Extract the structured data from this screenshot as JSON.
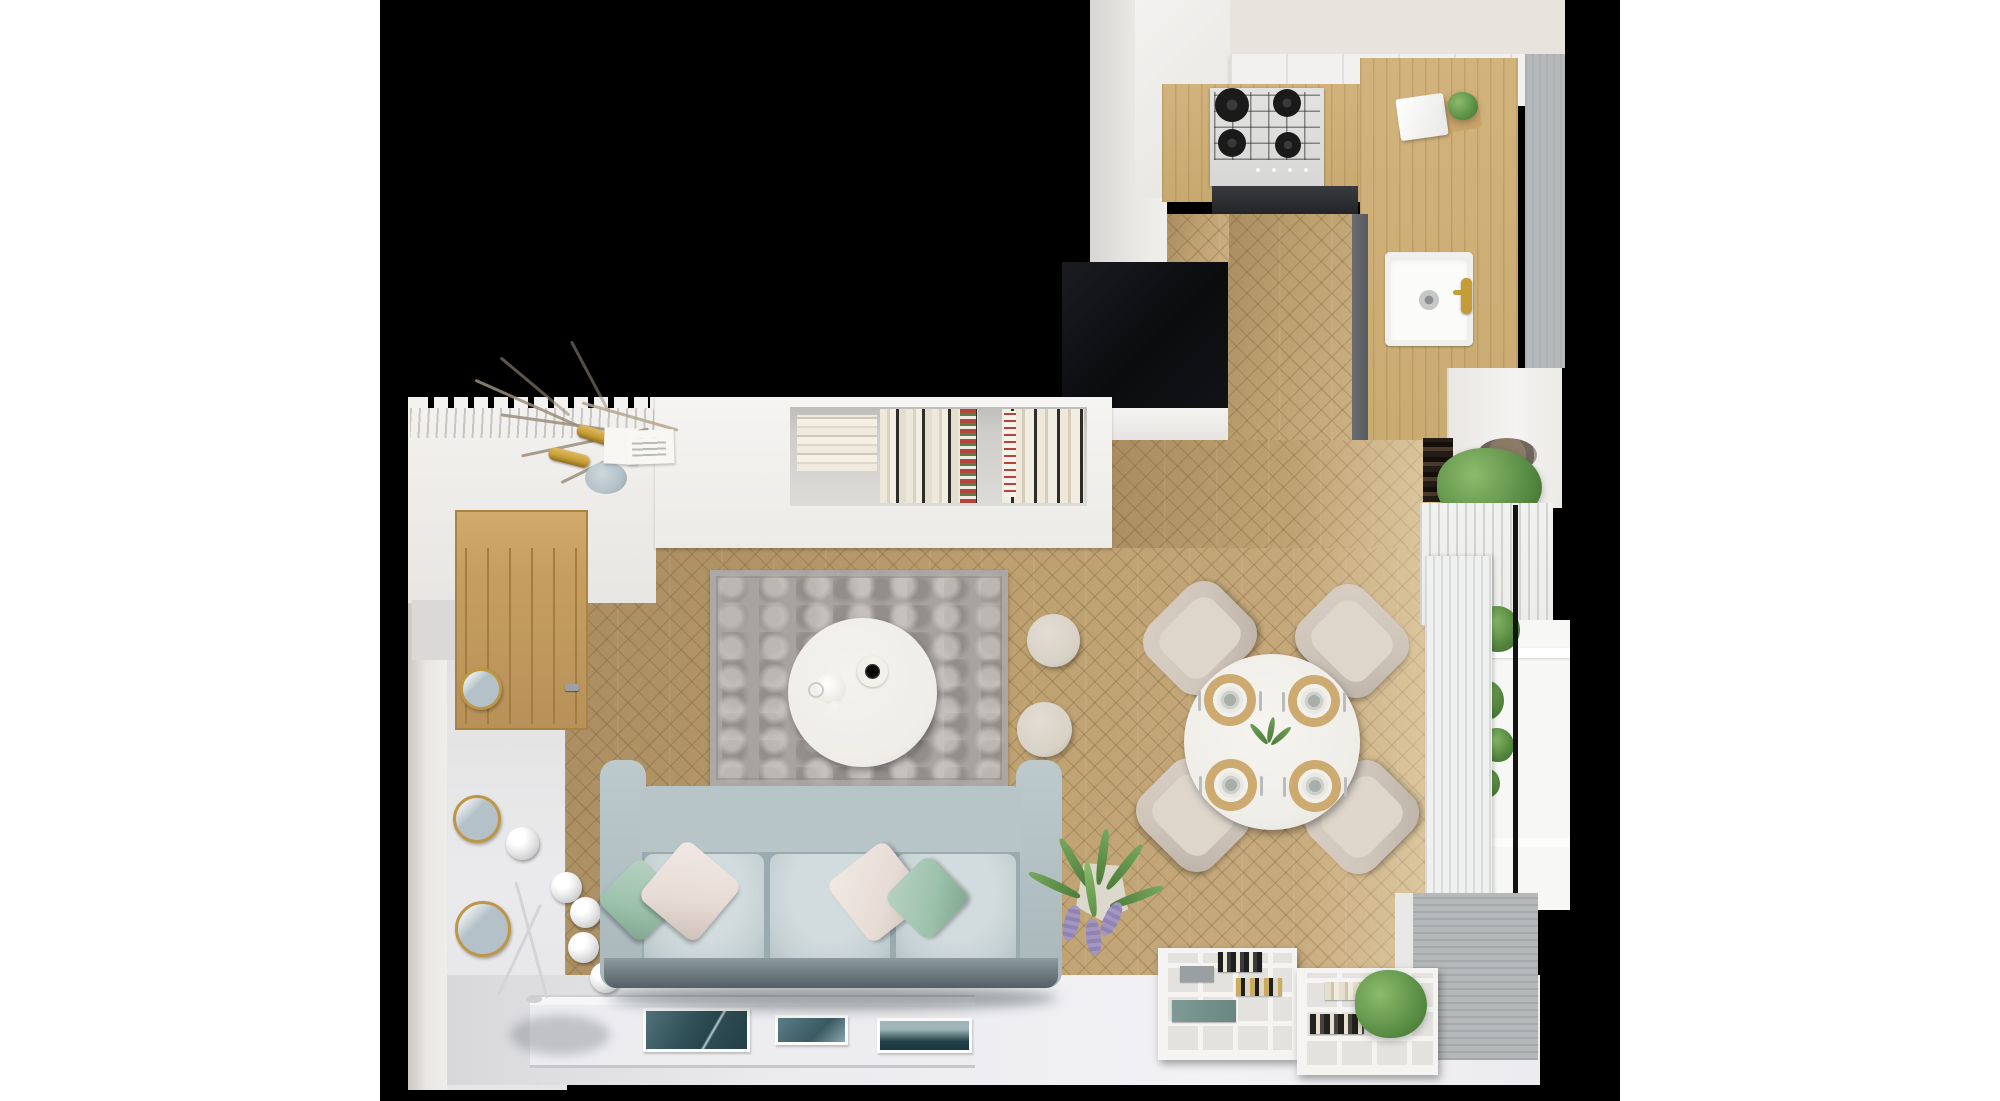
{
  "image": {
    "kind": "3d-render-top-down-floor-plan",
    "description": "Top-down architectural 3D render of a small apartment: open living room with light blue sofa, gray rug, round white coffee table, round dining table with four beige chairs, herringbone oak parquet, white bookshelf ledge, oak door, gold round mirrors, multi-sphere floor lamp, white cube shelving with books and plants, and an L-shaped kitchen with gas hob, oak counters, white sink and gold faucet; black background canvas with white page margins."
  },
  "palette": {
    "page-bg": "#ffffff",
    "render-bg": "#000000",
    "wall": "#e9e7e4",
    "cream-wall": "#e8e3dc",
    "cabinet": "#f2f1ef",
    "ledge": "#f3f2f0",
    "recess": "#cfcdc9",
    "counter-wood": "#c8a96f",
    "floor-wood": "#bda06f",
    "dark-front": "#232428",
    "gray-front": "#56595d",
    "steel": "#d7d8d6",
    "burner": "#1a1a1a",
    "sink": "#fbfbfa",
    "gold": "#c59d36",
    "curtain-gray": "#b5b8b9",
    "curtain-gray2": "#aeb1b3",
    "sheer": "#ececea",
    "beige-curtain": "#e6d5ae",
    "door-oak": "#c59e5f",
    "door-groove": "#a37d3f",
    "mirror-gold": "#bd9746",
    "mirror-glass": "#b4c1c8",
    "lamp": "#e9e9e9",
    "rug": "#a8a3a1",
    "table": "#efede8",
    "pouffe": "#d8d1c6",
    "sofa": "#b7c4c8",
    "sofa-arm": "#bccacd",
    "sofa-seat": "#c6d1d4",
    "sofa-seam": "#9aabb0",
    "sofa-front": "#525f64",
    "mint": "#9cc1ab",
    "blush": "#e7dbd5",
    "green": "#5d9148",
    "green-dark": "#41722f",
    "green-light": "#8cbb6c",
    "lavender": "#a195c6",
    "chair": "#cfc5bb",
    "chair-seat": "#ded6cb",
    "placemat": "#cdaa70",
    "radiator": "#eff0f0",
    "radiator-line": "#d8dada",
    "window": "#f7f7f5",
    "frame-black": "#141414",
    "floor-white-dark": "#d8d8db",
    "mat": "#ededf0",
    "mat-line": "#cfcfd4",
    "shelf": "#f5f4f2",
    "shelf-bg": "#e4e2de",
    "book-cream": "#eee8da",
    "book-dark": "#2e2c28",
    "book-red": "#b5453c",
    "book-green": "#5c7d45",
    "box-black": "#0b0c0e",
    "pot-pebble": "#8a7a66"
  },
  "scene": {
    "rooms": [
      "kitchen",
      "living-room",
      "dining-area"
    ],
    "kitchen_objects": [
      "gas-hob-4-burners",
      "oak-countertop",
      "white-upper-cabinets",
      "white-sink",
      "gold-faucet",
      "cutting-board",
      "towel",
      "small-plant",
      "gray-roman-blind",
      "herringbone-passage-floor",
      "black-gloss-cabinet"
    ],
    "living_objects": [
      "light-blue-3-seat-sofa",
      "mint-pillows",
      "blush-pillows",
      "gray-vintage-rug",
      "round-white-coffee-table",
      "black-coffee-cup",
      "white-teapot",
      "two-cream-pouffes",
      "white-bookshelf-ledge",
      "books",
      "dried-branch-arrangement",
      "blue-vase",
      "gold-wall-sconces",
      "leaning-art-frames",
      "oak-door",
      "three-gold-round-mirrors",
      "five-sphere-floor-lamp",
      "palm-plant-with-lavender",
      "white-cube-shelving-with-books",
      "potted-green-plants",
      "framed-teal-prints-on-floor",
      "white-painted-floor-border"
    ],
    "dining_objects": [
      "round-white-dining-table",
      "four-beige-chairs",
      "four-rattan-placemats-with-plates-and-cutlery",
      "green-centerpiece",
      "white-ribbed-radiator",
      "window-with-plants",
      "sheer-curtain",
      "gray-ribbed-curtain"
    ]
  }
}
